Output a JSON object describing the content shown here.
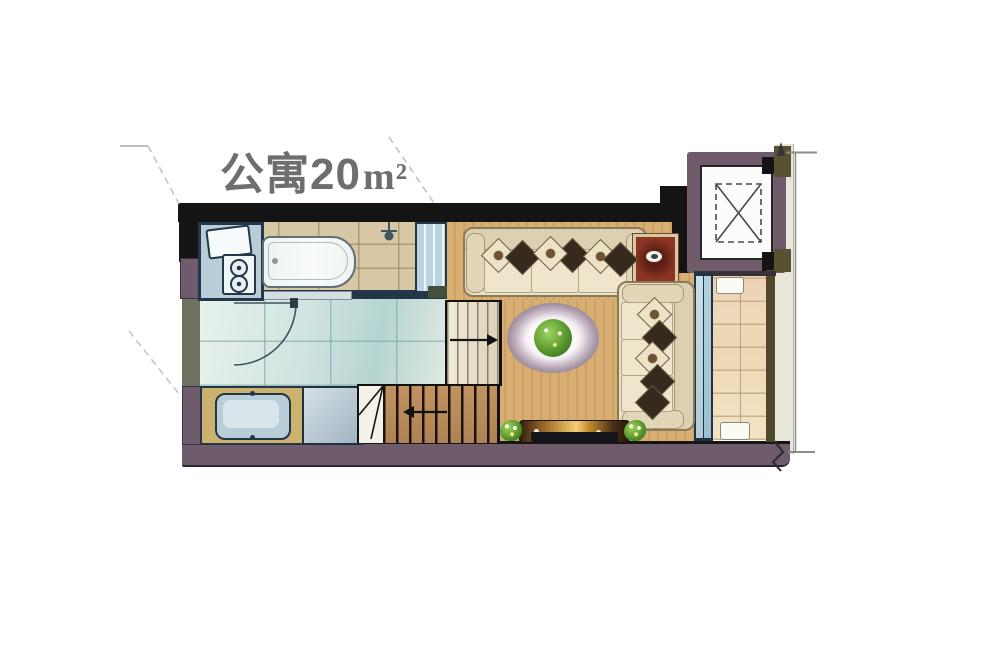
{
  "meta": {
    "type": "apartment-floor-plan"
  },
  "title": {
    "text": "公寓20",
    "unit": "m²",
    "full": "公寓20m²"
  },
  "palette": {
    "wall_dark": "#141414",
    "wall_mauve": "#6e5b6c",
    "wall_olive": "#575231",
    "elevator_wall": "#6f5b6a",
    "floor_wood": "#d2a96b",
    "tile_bath": "#d8c7a4",
    "tile_entry": "#bcd8d6",
    "tile_balcony": "#eedcba",
    "glass_blue": "#aecbd8",
    "counter_navy": "#223749",
    "sofa_cream": "#e9dfc6",
    "pillow_dark": "#352a1d",
    "accent_red_table": "#8c3524",
    "plant_green": "#4f8f27",
    "tv_gold": "#e3b65c",
    "dimension_gray": "#8b8b8b",
    "leader_dash_gray": "#c4c4c4",
    "title_gray": "#6e6e6e"
  },
  "fixtures": [
    "kitchen-counter",
    "kitchen-sink",
    "two-burner-stove",
    "bathtub",
    "shower-head",
    "glass-partition",
    "entry-door-swing",
    "vanity-sink",
    "washing-machine",
    "switchback-stairs",
    "stairs-up-arrow",
    "stairs-down-arrow",
    "sofa-horizontal",
    "sofa-vertical",
    "red-side-table",
    "round-coffee-table-with-plant",
    "tv-cabinet",
    "plant-left",
    "plant-right",
    "balcony-sliding-door",
    "balcony",
    "elevator-shaft",
    "dimension-line"
  ]
}
